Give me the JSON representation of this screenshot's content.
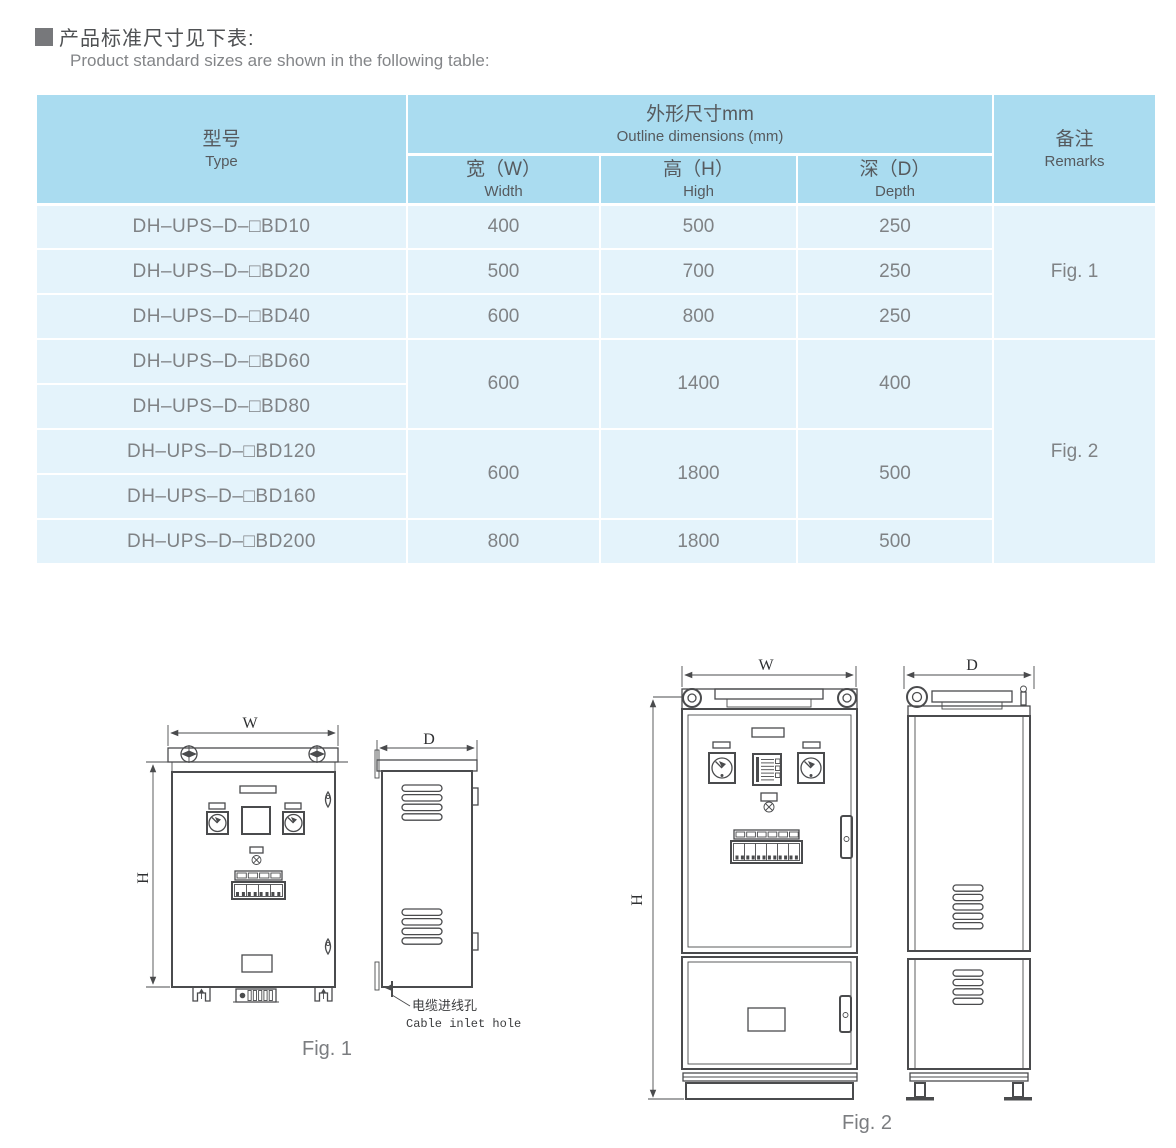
{
  "page": {
    "title_cn": "产品标准尺寸见下表:",
    "title_en": "Product standard sizes are shown in the following table:"
  },
  "colors": {
    "table_header_bg": "#aadcf0",
    "table_row_bg": "#e4f3fb",
    "drawing_line": "#4a4b4d",
    "text_gray": "#7f8285"
  },
  "table": {
    "header": {
      "type_cn": "型号",
      "type_en": "Type",
      "outline_cn": "外形尺寸mm",
      "outline_en": "Outline dimensions (mm)",
      "width_cn": "宽（W）",
      "width_en": "Width",
      "high_cn": "高（H）",
      "high_en": "High",
      "depth_cn": "深（D）",
      "depth_en": "Depth",
      "remarks_cn": "备注",
      "remarks_en": "Remarks"
    },
    "rows": [
      {
        "type": "DH–UPS–D–□BD10",
        "w": "400",
        "h": "500",
        "d": "250"
      },
      {
        "type": "DH–UPS–D–□BD20",
        "w": "500",
        "h": "700",
        "d": "250"
      },
      {
        "type": "DH–UPS–D–□BD40",
        "w": "600",
        "h": "800",
        "d": "250"
      },
      {
        "type": "DH–UPS–D–□BD60"
      },
      {
        "type": "DH–UPS–D–□BD80"
      },
      {
        "type": "DH–UPS–D–□BD120"
      },
      {
        "type": "DH–UPS–D–□BD160"
      },
      {
        "type": "DH–UPS–D–□BD200",
        "w": "800",
        "h": "1800",
        "d": "500"
      }
    ],
    "merged": {
      "g1": {
        "w": "600",
        "h": "1400",
        "d": "400"
      },
      "g2": {
        "w": "600",
        "h": "1800",
        "d": "500"
      }
    },
    "remarks": {
      "fig1": "Fig. 1",
      "fig2": "Fig. 2"
    }
  },
  "figures": {
    "fig1": {
      "caption": "Fig. 1",
      "w": "W",
      "h": "H",
      "d": "D",
      "callout_cn": "电缆进线孔",
      "callout_en": "Cable inlet hole"
    },
    "fig2": {
      "caption": "Fig. 2",
      "w": "W",
      "h": "H",
      "d": "D"
    }
  }
}
